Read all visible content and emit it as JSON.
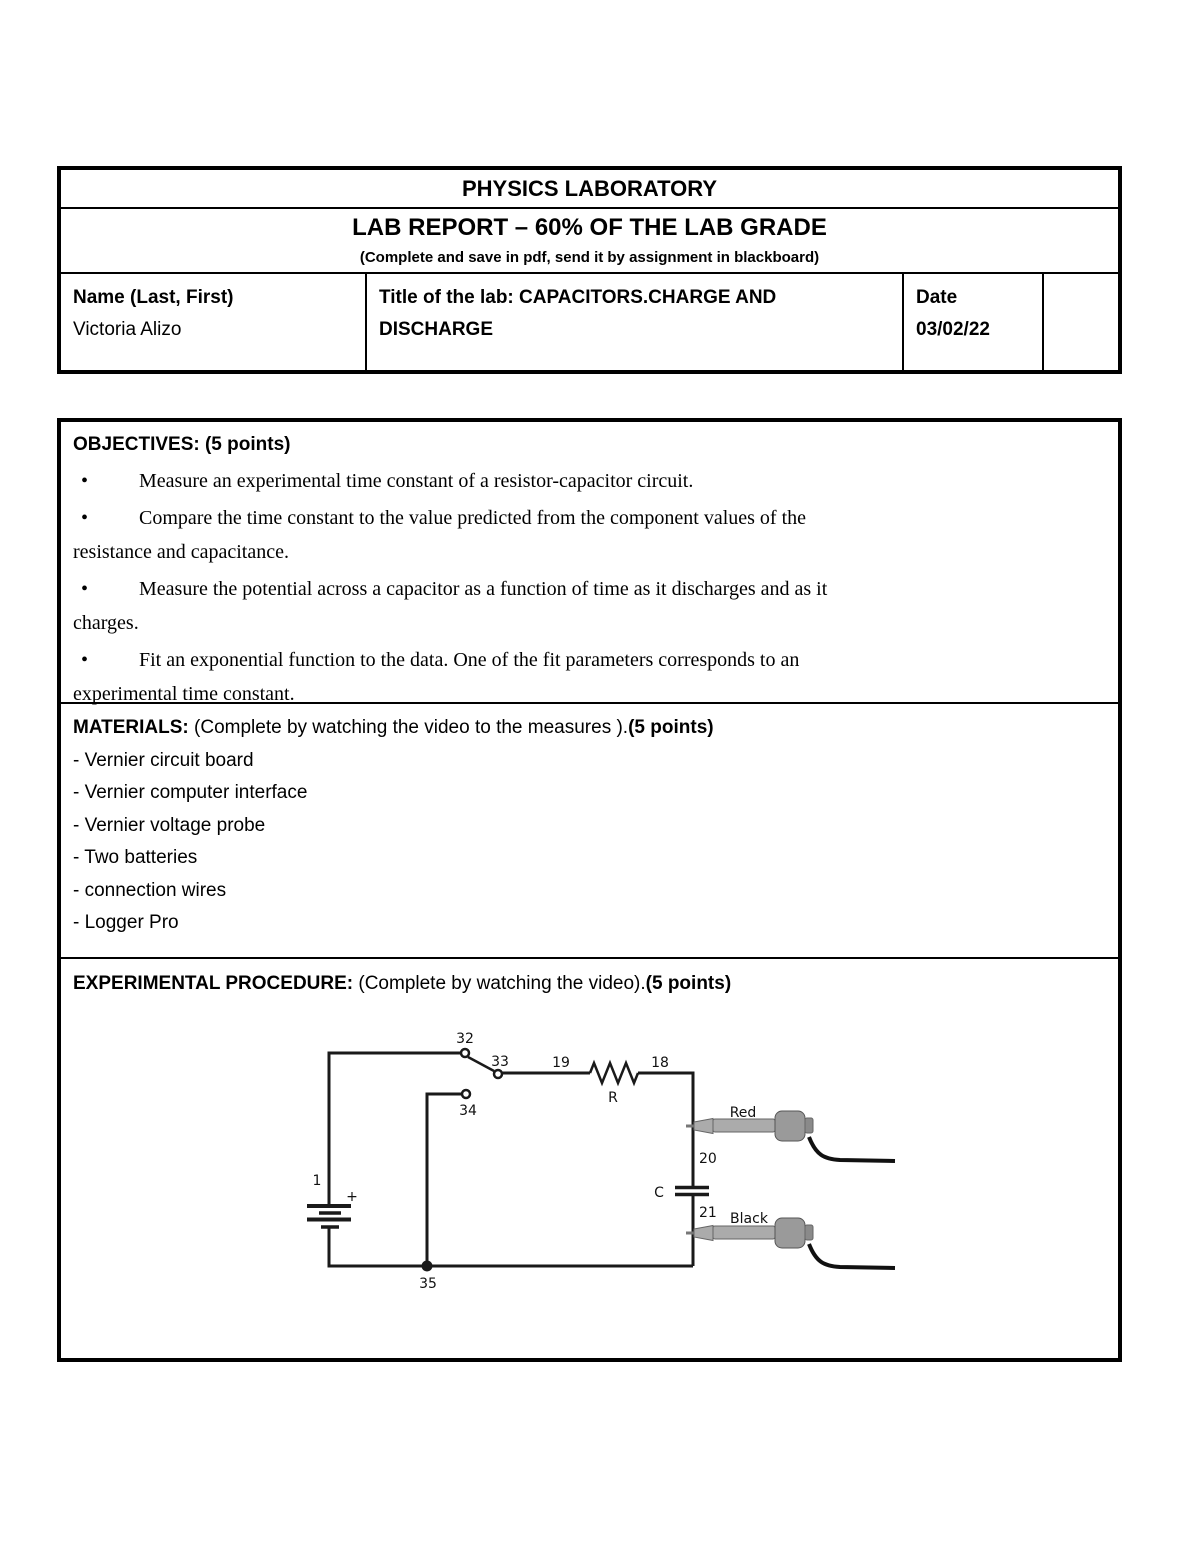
{
  "header_table": {
    "title": "PHYSICS LABORATORY",
    "subtitle": "LAB REPORT – 60% OF THE LAB GRADE",
    "subtitle_note": "(Complete and save in pdf, send it by assignment in blackboard)",
    "name_label": "Name (Last, First)",
    "name_value": "Victoria Alizo",
    "lab_title": "Title of the lab: CAPACITORS.CHARGE AND DISCHARGE",
    "date_label": "Date",
    "date_value": "03/02/22"
  },
  "objectives": {
    "heading": "OBJECTIVES: (5 points)",
    "bullet_char": "•",
    "bullets": [
      "Measure an experimental time constant of a resistor-capacitor circuit.",
      "Compare the time constant to the value predicted from the component values of the\nresistance and capacitance.",
      "Measure the potential across a capacitor as a function of time as it discharges and as it\ncharges.",
      "Fit an exponential function to the data. One of the fit parameters corresponds to an\nexperimental time constant."
    ]
  },
  "materials": {
    "heading_bold": "MATERIALS:",
    "heading_regular": " (Complete by watching the video to the measures ).",
    "heading_bold2": "(5 points)",
    "items": [
      "- Vernier circuit board",
      "- Vernier computer interface",
      "- Vernier voltage probe",
      "- Two batteries",
      "- connection wires",
      "- Logger Pro"
    ]
  },
  "procedure": {
    "heading_bold": "EXPERIMENTAL PROCEDURE:",
    "heading_regular": " (Complete by watching the video).",
    "heading_bold2": "(5 points)"
  },
  "circuit": {
    "battery_label": "1",
    "battery_plus": "+",
    "node_32": "32",
    "node_33": "33",
    "node_34": "34",
    "node_35": "35",
    "node_19": "19",
    "node_18": "18",
    "resistor_label": "R",
    "capacitor_label": "C",
    "node_20": "20",
    "node_21": "21",
    "probe_red_label": "Red",
    "probe_black_label": "Black"
  }
}
